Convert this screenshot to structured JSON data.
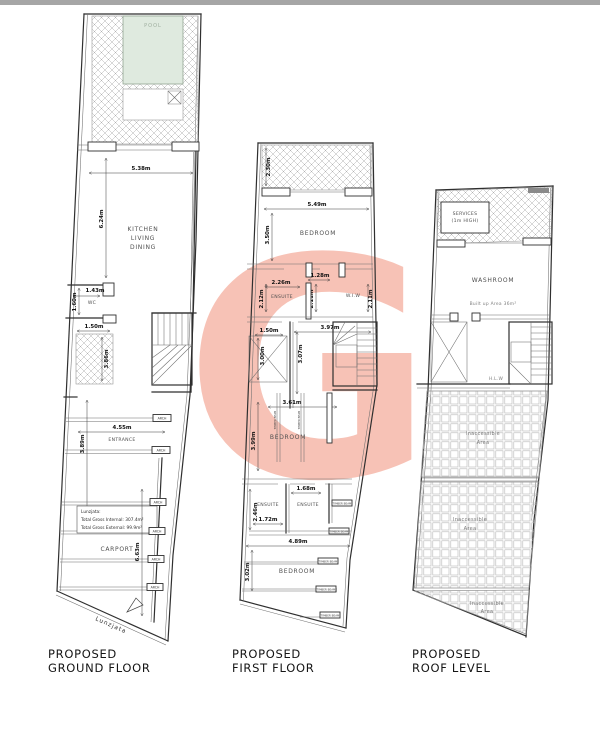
{
  "page": {
    "background": "#ffffff",
    "top_bar_color": "#a6a6a6"
  },
  "watermark": {
    "letter": "G",
    "color": "#f7c2b6"
  },
  "ground": {
    "title1": "PROPOSED",
    "title2": "GROUND FLOOR",
    "pool": "POOL",
    "pool_color": "#dfeadf",
    "kitchen1": "KITCHEN",
    "kitchen2": "LIVING",
    "kitchen3": "DINING",
    "wc": "WC",
    "entrance": "ENTRANCE",
    "carport": "CARPORT",
    "arch": "ARCH",
    "north": "Lunzjata",
    "note1": "Lunzjata:",
    "note2": "Total Gross Internal: 307.4m²",
    "note3": "Total Gross External: 99.9m²",
    "d538": "5.38m",
    "d624": "6.24m",
    "d143": "1.43m",
    "d160": "1.60m",
    "d150": "1.50m",
    "d386": "3.86m",
    "d455": "4.55m",
    "d389": "3.89m",
    "d663": "6.63m"
  },
  "first": {
    "title1": "PROPOSED",
    "title2": "FIRST FLOOR",
    "bedroom": "BEDROOM",
    "ensuite": "ENSUITE",
    "wiw": "W.I.W",
    "timber": "TIMBER BEAM",
    "d230": "2.30m",
    "d549": "5.49m",
    "d350": "3.50m",
    "d226": "2.26m",
    "d128": "1.28m",
    "d212": "2.12m",
    "d211": "2.11m",
    "d150": "1.50m",
    "d397": "3.97m",
    "d300": "3.00m",
    "d307": "3.07m",
    "d361": "3.61m",
    "d399": "3.99m",
    "d168": "1.68m",
    "d246": "2.46m",
    "d172": "1.72m",
    "d489": "4.89m",
    "d302": "3.02m"
  },
  "roof": {
    "title1": "PROPOSED",
    "title2": "ROOF LEVEL",
    "services1": "SERVICES",
    "services2": "(1m HIGH)",
    "washroom": "WASHROOM",
    "builtup": "Built up Area 36m²",
    "hlw": "H.L.W",
    "inaccessible1": "Inaccessible",
    "inaccessible2": "Area"
  }
}
